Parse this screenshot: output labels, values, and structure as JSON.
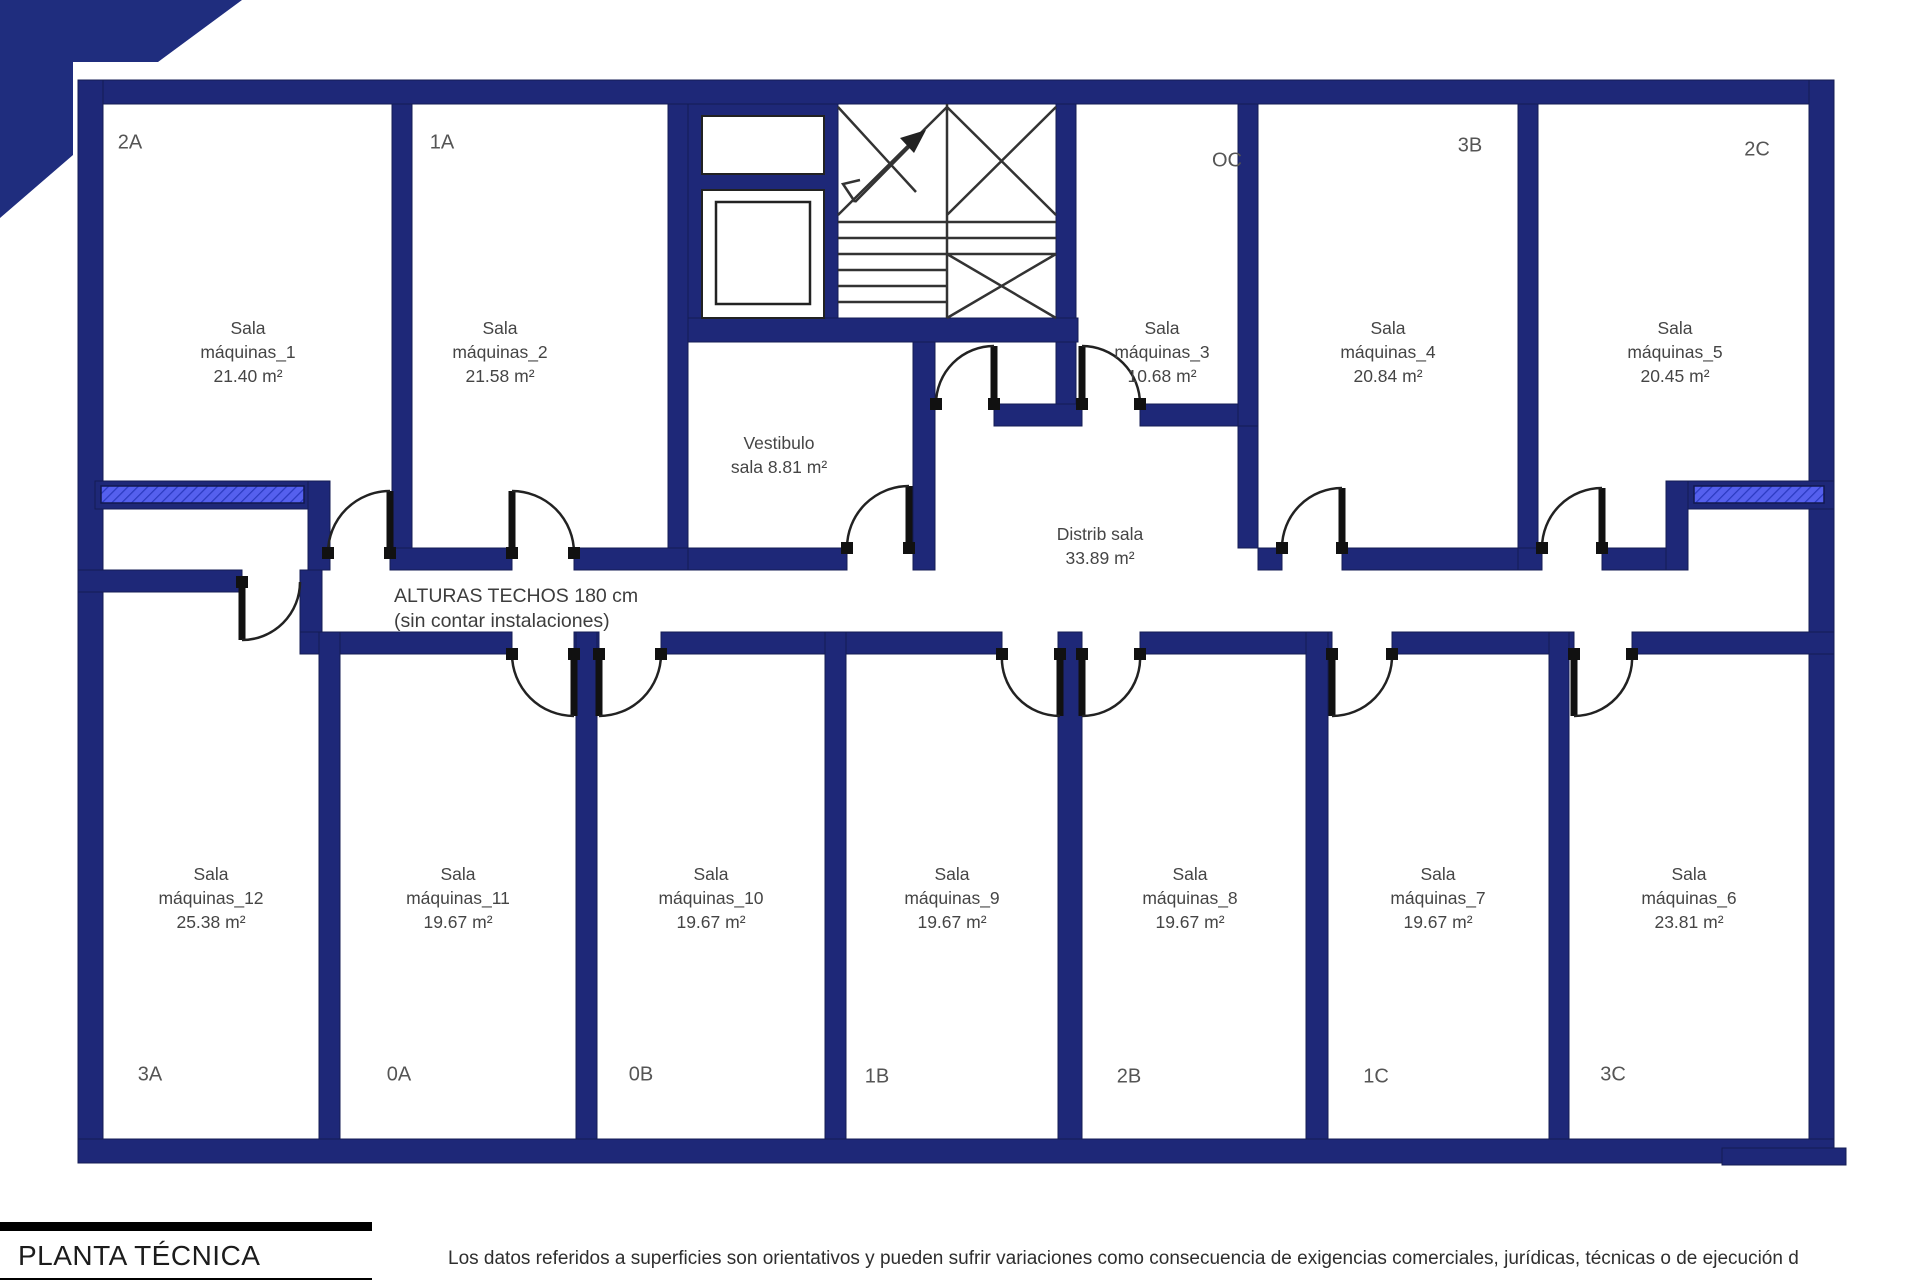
{
  "colors": {
    "wall": "#1e2878",
    "banner": "#1f2d7e",
    "glass": "#5560ee",
    "glass_hatch": "#2b3ac0"
  },
  "plan": {
    "ceiling_note": {
      "line1": "ALTURAS TECHOS 180 cm",
      "line2": "(sin contar instalaciones)"
    },
    "vestibule": {
      "line1": "Vestibulo",
      "line2": "sala 8.81 m²"
    },
    "corridor": {
      "line1": "Distrib sala",
      "line2": "33.89 m²"
    },
    "rooms": [
      {
        "unit": "2A",
        "name": "Sala",
        "label": "máquinas_1",
        "area": "21.40 m²"
      },
      {
        "unit": "1A",
        "name": "Sala",
        "label": "máquinas_2",
        "area": "21.58 m²"
      },
      {
        "unit": "OC",
        "name": "Sala",
        "label": "máquinas_3",
        "area": "10.68 m²"
      },
      {
        "unit": "3B",
        "name": "Sala",
        "label": "máquinas_4",
        "area": "20.84 m²"
      },
      {
        "unit": "2C",
        "name": "Sala",
        "label": "máquinas_5",
        "area": "20.45 m²"
      },
      {
        "unit": "3C",
        "name": "Sala",
        "label": "máquinas_6",
        "area": "23.81 m²"
      },
      {
        "unit": "1C",
        "name": "Sala",
        "label": "máquinas_7",
        "area": "19.67 m²"
      },
      {
        "unit": "2B",
        "name": "Sala",
        "label": "máquinas_8",
        "area": "19.67 m²"
      },
      {
        "unit": "1B",
        "name": "Sala",
        "label": "máquinas_9",
        "area": "19.67 m²"
      },
      {
        "unit": "0B",
        "name": "Sala",
        "label": "máquinas_10",
        "area": "19.67 m²"
      },
      {
        "unit": "0A",
        "name": "Sala",
        "label": "máquinas_11",
        "area": "19.67 m²"
      },
      {
        "unit": "3A",
        "name": "Sala",
        "label": "máquinas_12",
        "area": "25.38 m²"
      }
    ]
  },
  "title_block": {
    "title": "PLANTA TÉCNICA"
  },
  "footer": {
    "disclaimer": "Los datos referidos a superficies son orientativos y pueden sufrir variaciones como consecuencia de exigencias comerciales, jurídicas, técnicas o de ejecución d"
  }
}
